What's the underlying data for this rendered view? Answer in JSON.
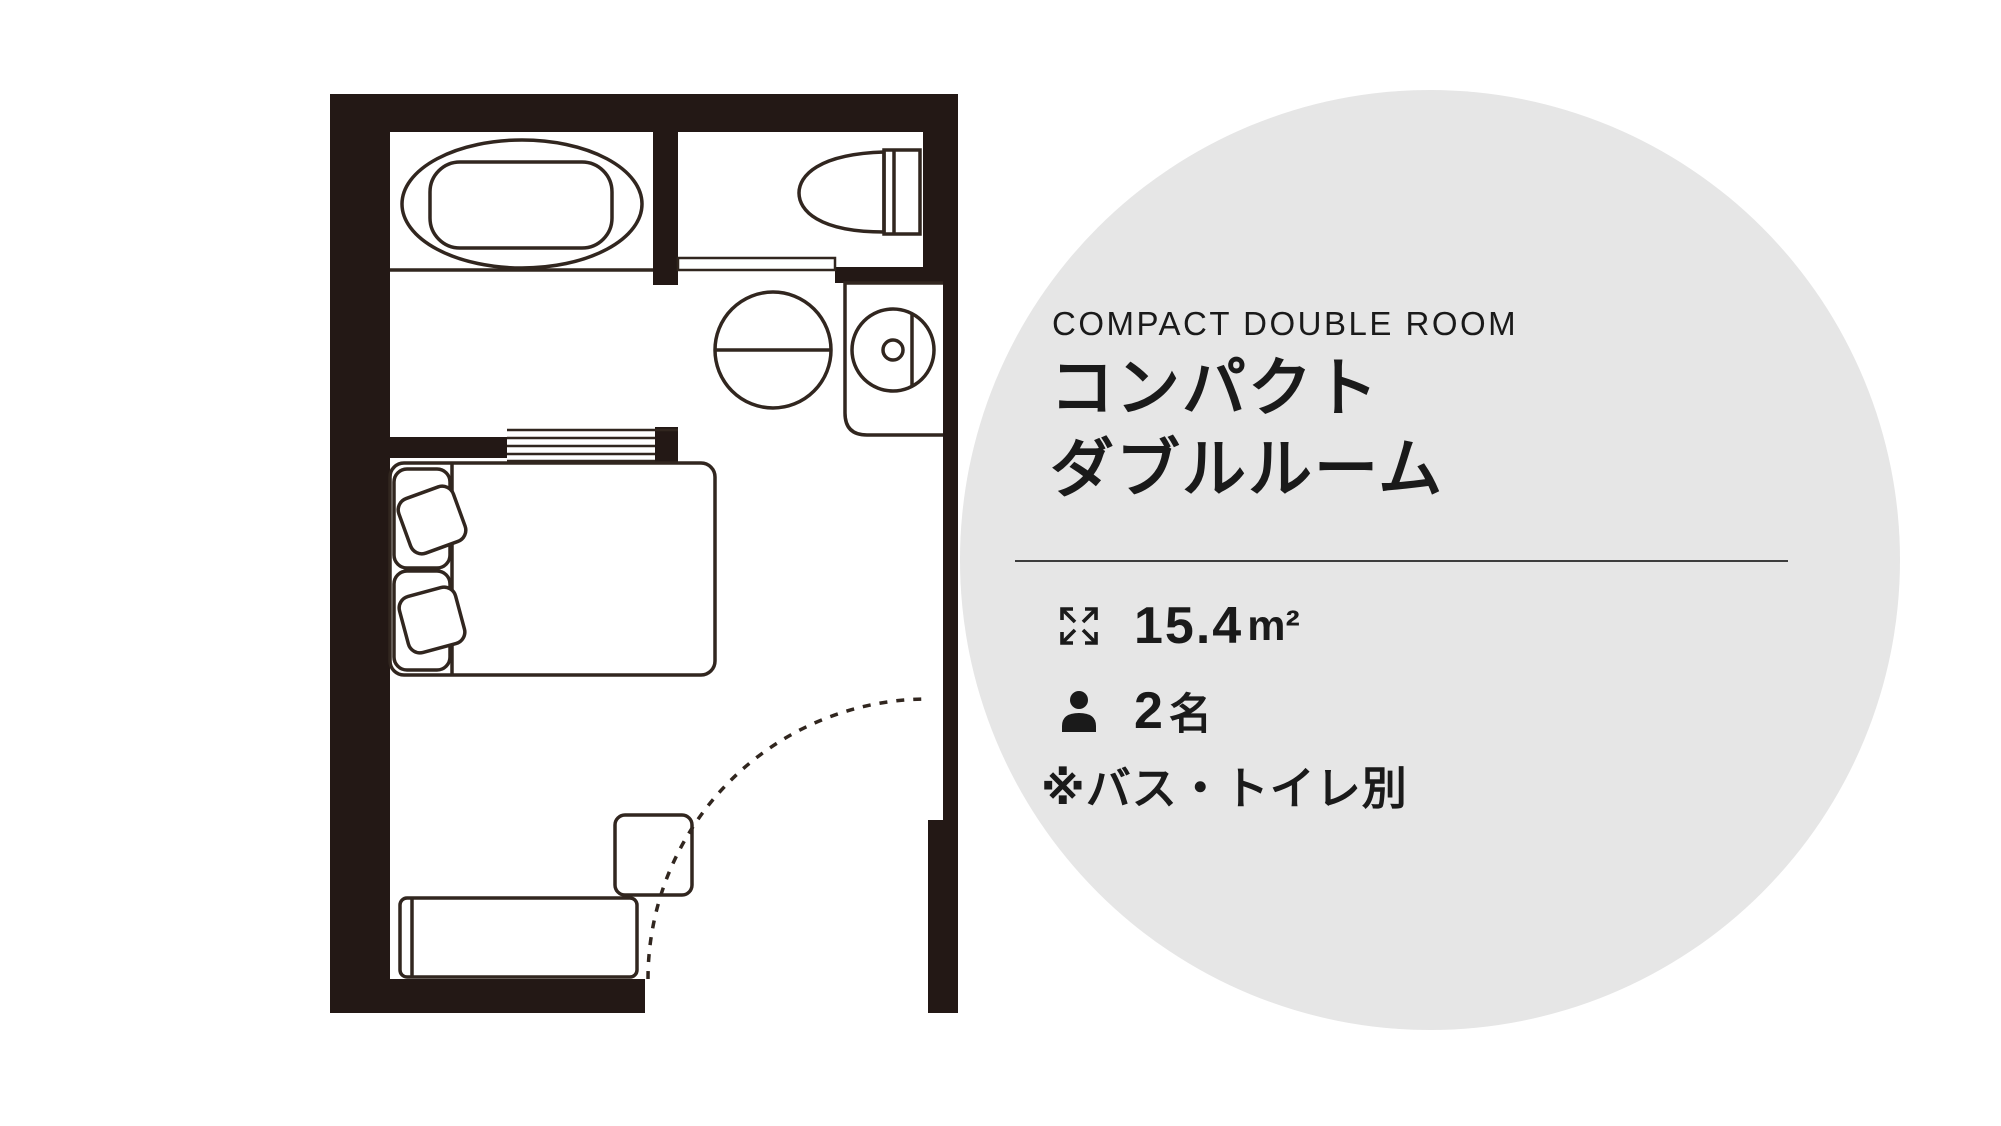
{
  "info_panel": {
    "title_en": "COMPACT DOUBLE ROOM",
    "title_ja_line1": "コンパクト",
    "title_ja_line2": "ダブルルーム",
    "area": {
      "icon": "expand-arrows-icon",
      "value": "15.4",
      "unit": "m²"
    },
    "capacity": {
      "icon": "person-icon",
      "value": "2",
      "unit": "名"
    },
    "note": "※バス・トイレ別"
  },
  "floor_plan": {
    "label": "コンパクトダブルルーム間取り図",
    "rooms": [
      "bathroom",
      "toilet-room",
      "washbasin-area",
      "bedroom"
    ],
    "fixtures": [
      "bathtub",
      "sliding-door-track",
      "toilet",
      "toilet-door",
      "washbasin",
      "counter",
      "faucet",
      "double-bed",
      "pillows",
      "head-cushions",
      "desk",
      "chair",
      "entrance-door-swing"
    ]
  },
  "theme": {
    "wall": "#231815",
    "line": "#31261f",
    "circle-bg": "#e6e6e6",
    "text": "#1a1a1a",
    "divider": "#3d3d3d"
  }
}
